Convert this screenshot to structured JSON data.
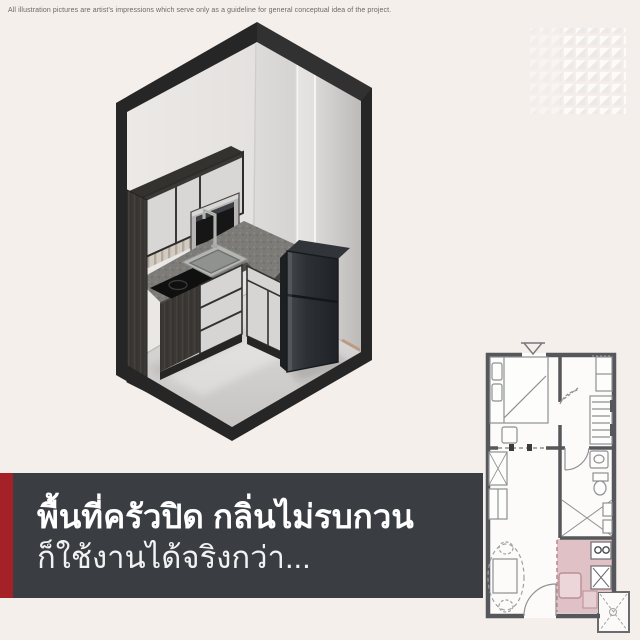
{
  "page": {
    "background_color": "#f5efec",
    "width": 640,
    "height": 640
  },
  "disclaimer": {
    "text": "All illustration pictures are artist's impressions which serve only as a guideline for general conceptual idea of the project."
  },
  "headline_banner": {
    "line1": "พื้นที่ครัวปิด กลิ่นไม่รบกวน",
    "line2": "ก็ใช้งานได้จริงกว่า...",
    "background_color": "#3a3d42",
    "accent_bar_color": "#a32127",
    "text_color": "#ffffff"
  },
  "kitchen_illustration": {
    "kind": "isometric 3D cutaway of closed kitchen",
    "frame_color": "#262626",
    "elements": [
      "upper-cabinet",
      "microwave",
      "tile-backsplash",
      "induction-hob",
      "sink",
      "faucet",
      "l-shaped-granite-counter",
      "base-cabinet-drawers",
      "refrigerator",
      "sliding-glass-door",
      "wood-side-panel"
    ]
  },
  "floor_plan": {
    "kind": "unit floor plan",
    "highlighted_room": "kitchen",
    "highlight_color": "#dfc1c6",
    "rooms": [
      "bedroom",
      "wardrobe",
      "bathroom",
      "living-dining",
      "kitchen",
      "balcony"
    ]
  },
  "watermark": {
    "kind": "grid logo pattern",
    "rows": 8,
    "cols": 8
  }
}
